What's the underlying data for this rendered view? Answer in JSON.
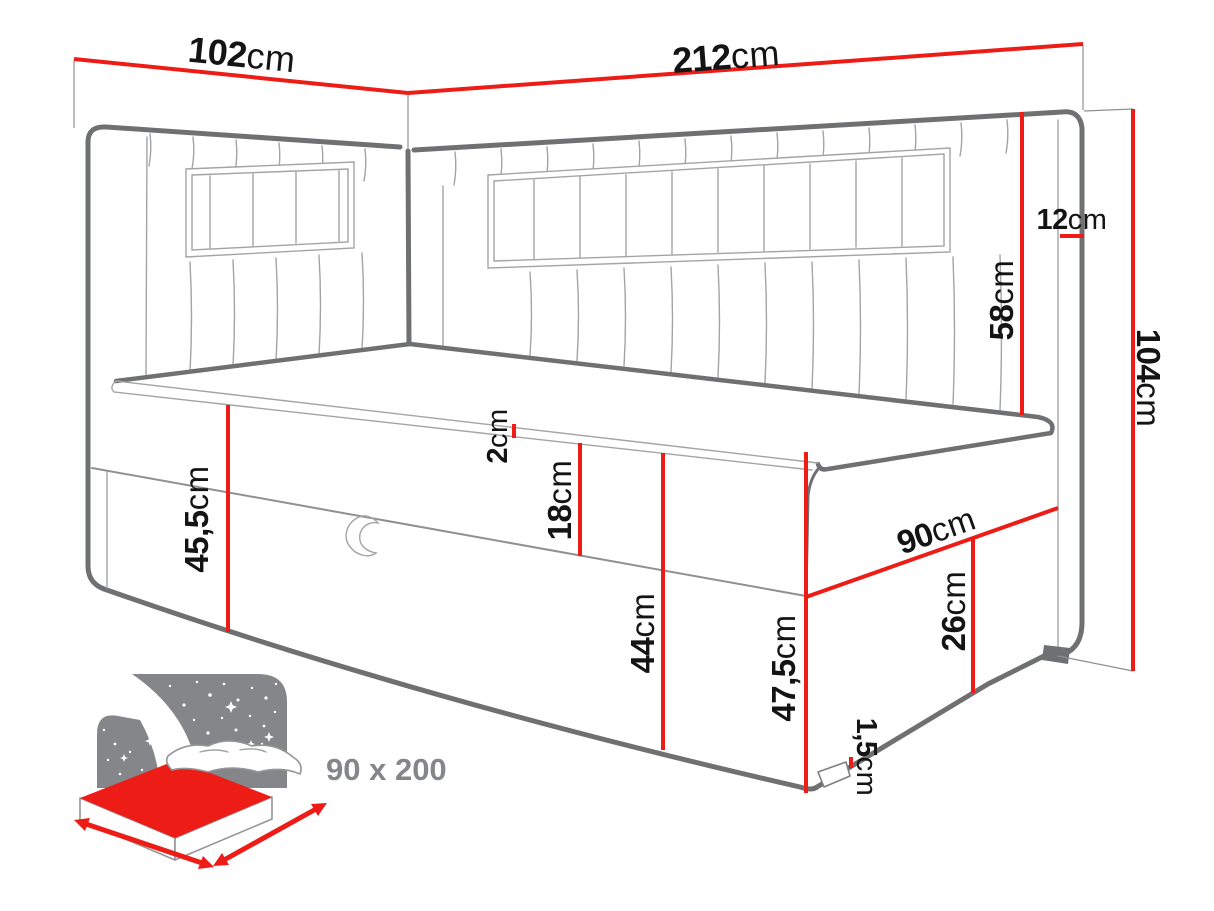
{
  "colors": {
    "accent_red": "#ed1c16",
    "outline": "#6f7072",
    "thin_line": "#a3a4a6",
    "label": "#141414",
    "icon_grey": "#85868a",
    "background": "#ffffff"
  },
  "labels": {
    "w102": {
      "num": "102",
      "unit": "cm"
    },
    "w212": {
      "num": "212",
      "unit": "cm"
    },
    "d12": {
      "num": "12",
      "unit": "cm"
    },
    "h58": {
      "num": "58",
      "unit": "cm"
    },
    "h104": {
      "num": "104",
      "unit": "cm"
    },
    "h455": {
      "num": "45,5",
      "unit": "cm"
    },
    "t2": {
      "num": "2",
      "unit": "cm"
    },
    "h18": {
      "num": "18",
      "unit": "cm"
    },
    "h44": {
      "num": "44",
      "unit": "cm"
    },
    "h475": {
      "num": "47,5",
      "unit": "cm"
    },
    "w90": {
      "num": "90",
      "unit": "cm"
    },
    "h26": {
      "num": "26",
      "unit": "cm"
    },
    "h15": {
      "num": "1,5",
      "unit": "cm"
    }
  },
  "size_icon": {
    "label": "90 x 200"
  }
}
